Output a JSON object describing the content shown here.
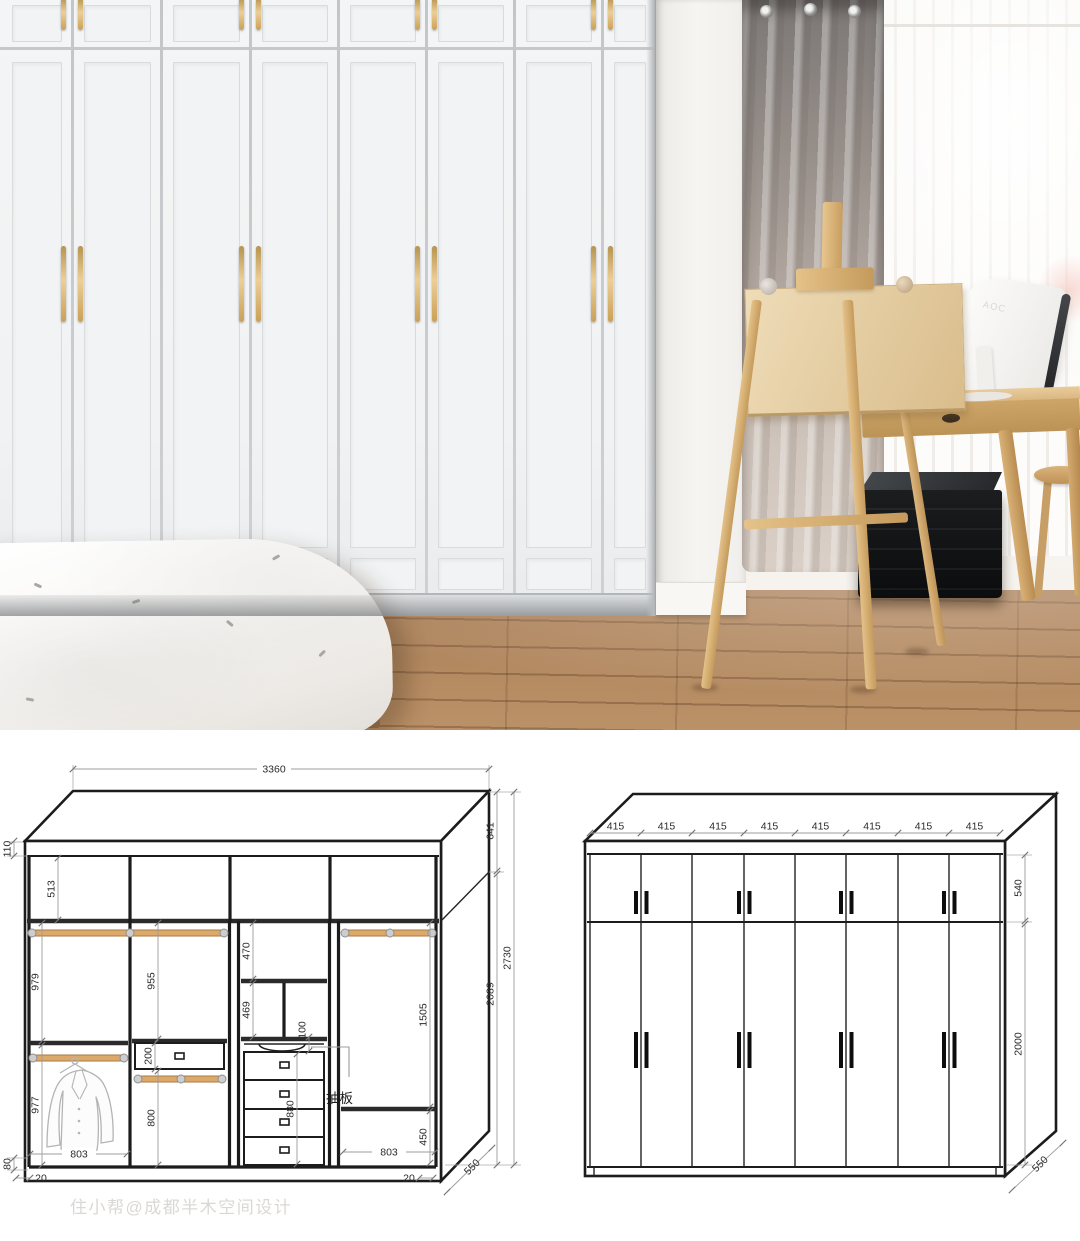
{
  "watermark": "住小帮@成都半木空间设计",
  "photo": {
    "monitor_logo": "AOC"
  },
  "palette": {
    "drawing_line": "#1c1c1c",
    "dimension_gray": "#9c9c9c",
    "rod_wood": "#dda96b",
    "handle_gold": "#caa45f",
    "floor_wood": "#ab8159",
    "curtain_taupe": "#a2978f"
  },
  "left_drawing": {
    "dims": {
      "overall_width": "3360",
      "crown_height": "110",
      "top_row_height": "513",
      "col1_upper_height": "979",
      "col1_lower_height": "977",
      "col1_width": "803",
      "plinth_height": "80",
      "side_gap_left": "20",
      "side_gap_right": "20",
      "col2_upper_height": "955",
      "drawer_height": "200",
      "col2_lower_height": "800",
      "col3_top_height": "470",
      "col3_shelf_height": "469",
      "pullout_gap": "100",
      "drawer_stack_height": "880",
      "pullout_label": "抽板",
      "col4_hanging_height": "1505",
      "col4_bottom_height": "450",
      "col4_width": "803",
      "top_section_height": "641",
      "body_height": "2089",
      "total_height": "2730",
      "depth": "550"
    }
  },
  "right_drawing": {
    "door_widths": [
      "415",
      "415",
      "415",
      "415",
      "415",
      "415",
      "415",
      "415"
    ],
    "upper_door_height": "540",
    "lower_door_height": "2000",
    "depth": "550"
  }
}
